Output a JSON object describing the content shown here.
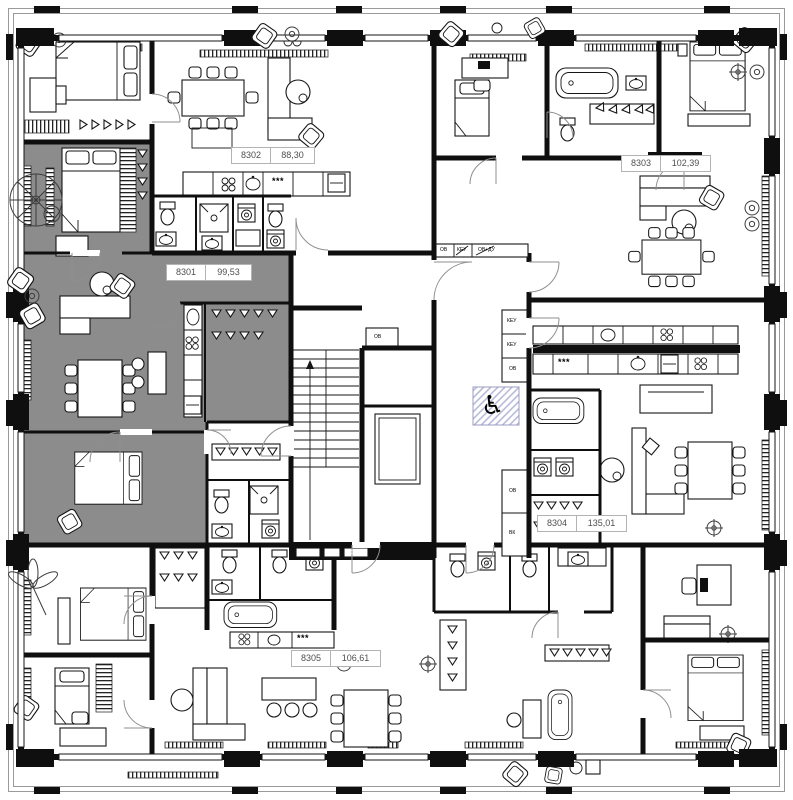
{
  "plan": {
    "kind": "residential floor plan",
    "highlighted_apartment": "8301"
  },
  "apartments": [
    {
      "number": "8301",
      "area": "99,53",
      "highlighted": true
    },
    {
      "number": "8302",
      "area": "88,30",
      "highlighted": false
    },
    {
      "number": "8303",
      "area": "102,39",
      "highlighted": false
    },
    {
      "number": "8304",
      "area": "135,01",
      "highlighted": false
    },
    {
      "number": "8305",
      "area": "106,61",
      "highlighted": false
    }
  ],
  "core": {
    "accessible_icon": "♿",
    "shafts": {
      "band": [
        "ОВ",
        "КЕУ",
        "ОВ+ДУ"
      ],
      "column": [
        "КЕУ",
        "КЕУ",
        "ОВ"
      ],
      "column2": [
        "ОВ",
        "ВК"
      ],
      "bottom": [
        "ЭОМ",
        "ВК",
        "ЭОМ"
      ],
      "lobby": "ОВ"
    }
  },
  "symbols": {
    "stove_mark": "***"
  },
  "colors": {
    "wall": "#0f0f0f",
    "highlight": "#8c8c8c",
    "hatch": "#b9b9da",
    "label_border": "#b3b3b3",
    "label_text": "#4f4f4f",
    "frame": "#9a9a9a"
  }
}
